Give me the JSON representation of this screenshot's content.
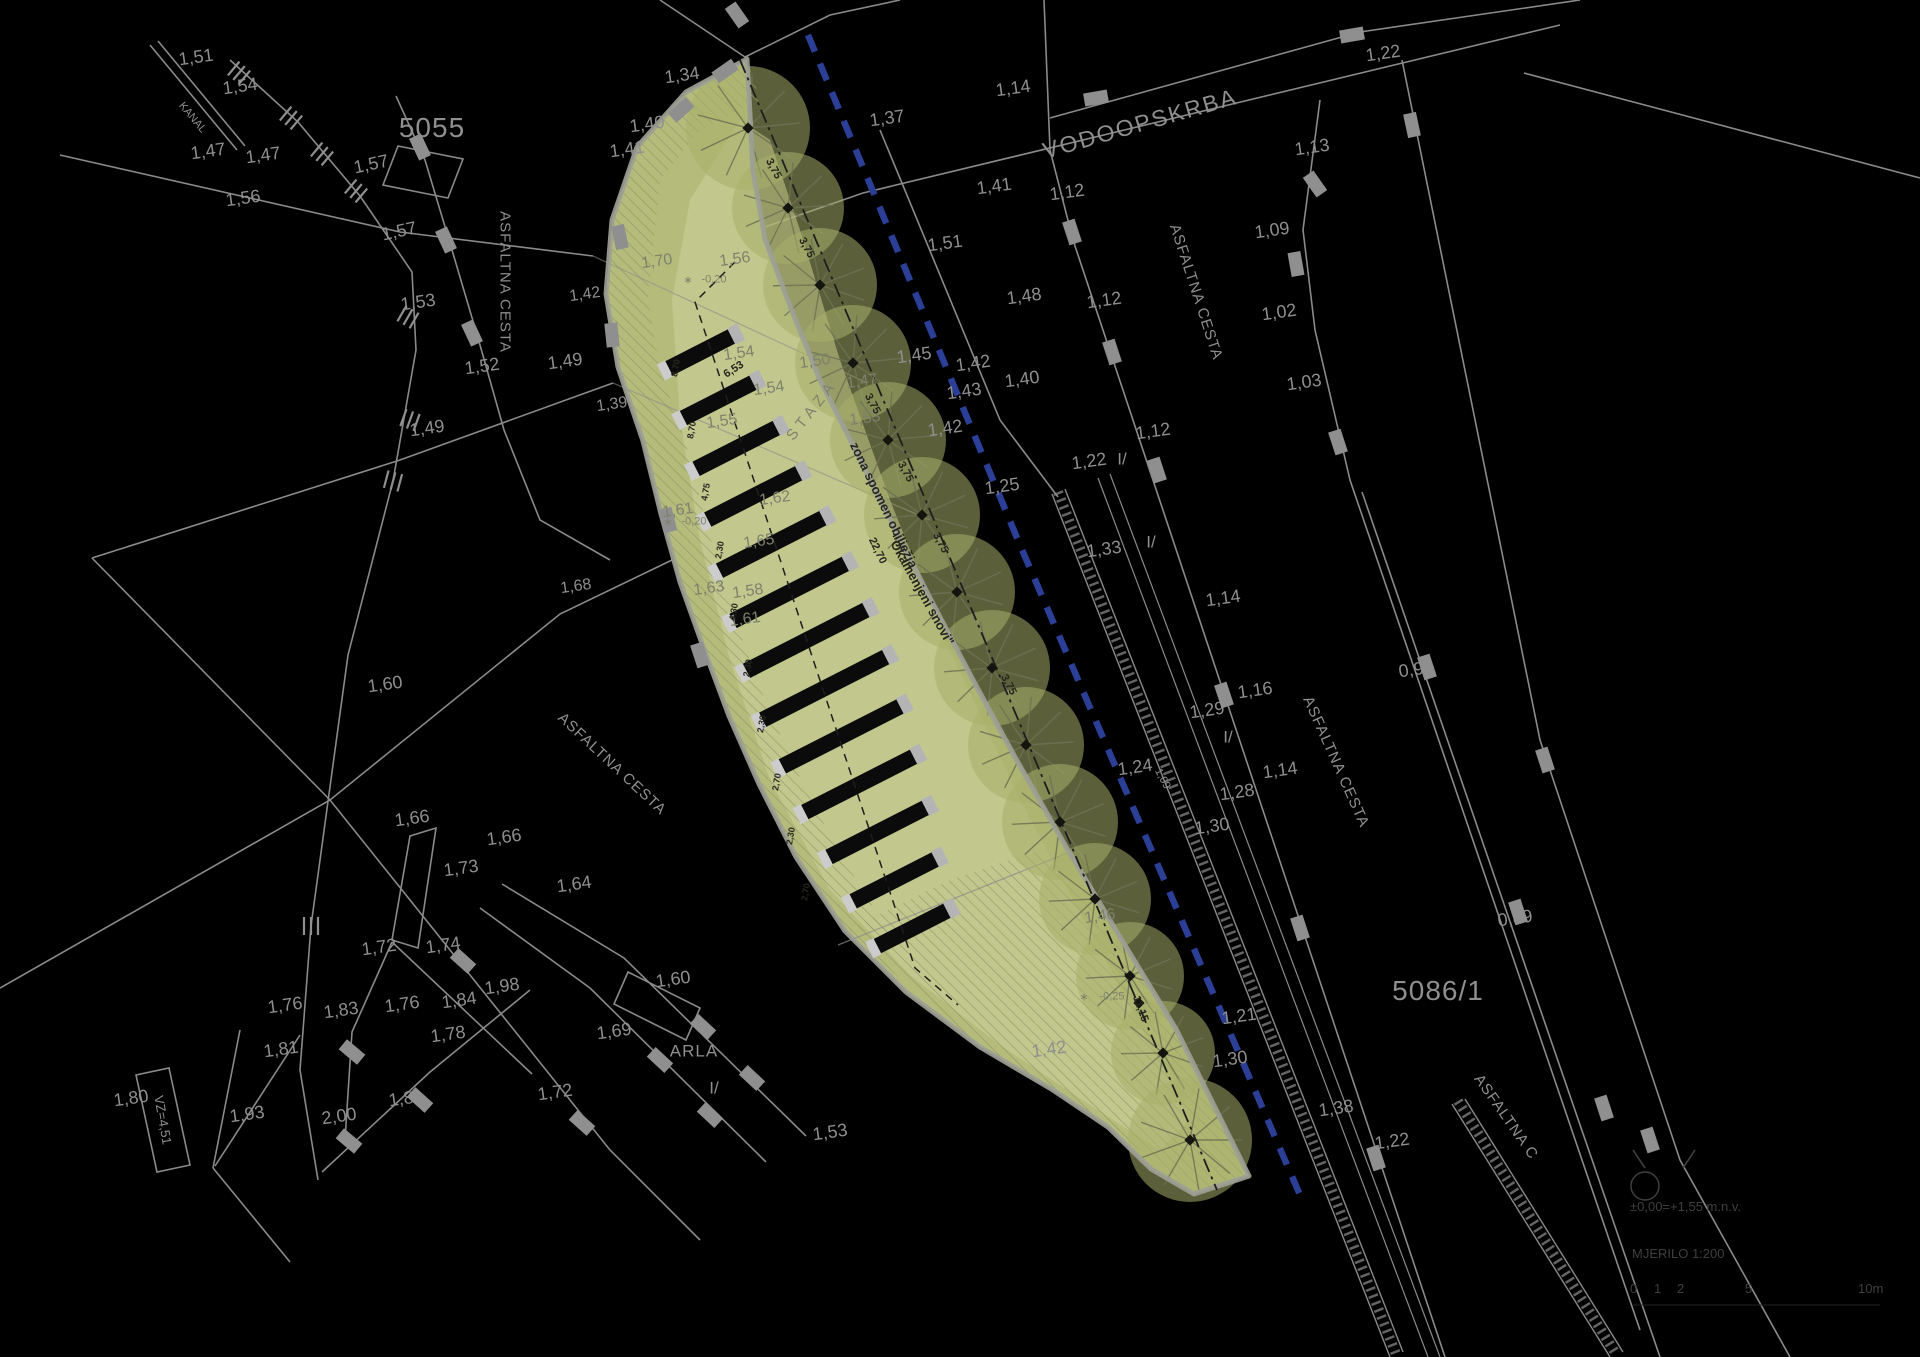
{
  "legend": {
    "datum_label": "±0,00=+1,55 m.n.v.",
    "scale_label": "MJERILO 1:200",
    "scalebar_ticks": [
      "0",
      "1",
      "2",
      "5",
      "10m"
    ]
  },
  "parcels": {
    "left": "5055",
    "right": "5086/1"
  },
  "zone_note": "zona spomen obilježja \"Okamenjeni snovi\"",
  "colors": {
    "background": "#000000",
    "line_gray": "#8a8a8a",
    "text_gray": "#8f8f8f",
    "green_base": "#b5bc7b",
    "green_light": "#c9ce97",
    "green_tree": "#a7ae6a",
    "border_gray": "#9da095",
    "blue_line": "#2b3f96",
    "legend_gray": "#3f3f3f"
  },
  "labels": [
    [
      "1,51",
      196,
      57,
      -8,
      18,
      "g"
    ],
    [
      "1,54",
      240,
      86,
      -8,
      18,
      "g"
    ],
    [
      "KANAL",
      192,
      118,
      50,
      11,
      "g"
    ],
    [
      "1,47",
      208,
      151,
      -8,
      18,
      "g"
    ],
    [
      "1,47",
      263,
      155,
      -8,
      18,
      "g"
    ],
    [
      "1,56",
      243,
      198,
      -8,
      18,
      "g"
    ],
    [
      "5055",
      432,
      128,
      0,
      28,
      "g",
      1
    ],
    [
      "1,57",
      371,
      164,
      -12,
      18,
      "g"
    ],
    [
      "1,57",
      399,
      231,
      -12,
      18,
      "g"
    ],
    [
      "1,53",
      418,
      302,
      -8,
      18,
      "g"
    ],
    [
      "ASFALTNA CESTA",
      505,
      282,
      90,
      15,
      "g",
      1
    ],
    [
      "1,52",
      482,
      366,
      -8,
      18,
      "g"
    ],
    [
      "1,49",
      565,
      361,
      -8,
      18,
      "g"
    ],
    [
      "1,49",
      427,
      428,
      -8,
      18,
      "g"
    ],
    [
      "1,60",
      385,
      684,
      -8,
      18,
      "g"
    ],
    [
      "ASFALTNA CESTA",
      612,
      764,
      43,
      15,
      "g",
      1
    ],
    [
      "1,66",
      412,
      818,
      -8,
      18,
      "g"
    ],
    [
      "1,66",
      504,
      837,
      -8,
      18,
      "g"
    ],
    [
      "1,73",
      461,
      868,
      -8,
      18,
      "g"
    ],
    [
      "1,64",
      574,
      884,
      -8,
      18,
      "g"
    ],
    [
      "1,72",
      379,
      947,
      -8,
      18,
      "g"
    ],
    [
      "1,74",
      443,
      945,
      -8,
      18,
      "g"
    ],
    [
      "1,98",
      502,
      986,
      -8,
      18,
      "g"
    ],
    [
      "1,84",
      459,
      1000,
      -8,
      18,
      "g"
    ],
    [
      "1,76",
      285,
      1005,
      -8,
      18,
      "g"
    ],
    [
      "1,76",
      402,
      1004,
      -8,
      18,
      "g"
    ],
    [
      "1,83",
      341,
      1010,
      -8,
      18,
      "g"
    ],
    [
      "1,78",
      448,
      1034,
      -8,
      18,
      "g"
    ],
    [
      "1,81",
      281,
      1049,
      -8,
      18,
      "g"
    ],
    [
      "1,80",
      131,
      1098,
      -8,
      18,
      "g"
    ],
    [
      "VZ=4,51",
      163,
      1120,
      80,
      13,
      "g"
    ],
    [
      "1,93",
      247,
      1114,
      -8,
      18,
      "g"
    ],
    [
      "2,00",
      339,
      1116,
      -8,
      18,
      "g"
    ],
    [
      "1,81",
      406,
      1098,
      -8,
      18,
      "g"
    ],
    [
      "1,69",
      614,
      1031,
      -8,
      18,
      "g"
    ],
    [
      "ARLA",
      694,
      1051,
      0,
      17,
      "g",
      1
    ],
    [
      "I/",
      714,
      1088,
      0,
      17,
      "g"
    ],
    [
      "1,72",
      555,
      1092,
      -8,
      18,
      "g"
    ],
    [
      "1,60",
      673,
      979,
      -8,
      18,
      "g"
    ],
    [
      "1,53",
      830,
      1132,
      -8,
      18,
      "g"
    ],
    [
      "1,34",
      682,
      75,
      -8,
      18,
      "g"
    ],
    [
      "1,40",
      647,
      124,
      -8,
      18,
      "g"
    ],
    [
      "1,41",
      627,
      149,
      -8,
      18,
      "g"
    ],
    [
      "1,37",
      887,
      118,
      -8,
      18,
      "g"
    ],
    [
      "1,14",
      1013,
      88,
      -8,
      18,
      "g"
    ],
    [
      "VODOOPSKRBA",
      1140,
      124,
      -16,
      23,
      "g",
      2
    ],
    [
      "1,41",
      994,
      186,
      -8,
      18,
      "g"
    ],
    [
      "1,12",
      1067,
      192,
      -8,
      18,
      "g"
    ],
    [
      "1,51",
      945,
      243,
      -8,
      18,
      "g"
    ],
    [
      "1,48",
      1024,
      296,
      -8,
      18,
      "g"
    ],
    [
      "1,12",
      1104,
      300,
      -8,
      18,
      "g"
    ],
    [
      "1,09",
      1272,
      230,
      -8,
      18,
      "g"
    ],
    [
      "1,02",
      1279,
      312,
      -8,
      18,
      "g"
    ],
    [
      "1,03",
      1304,
      382,
      -8,
      18,
      "g"
    ],
    [
      "1,13",
      1312,
      147,
      -8,
      18,
      "g"
    ],
    [
      "1,22",
      1383,
      53,
      -8,
      18,
      "g"
    ],
    [
      "ASFALTNA CESTA",
      1196,
      292,
      72,
      15,
      "g",
      1
    ],
    [
      "1,45",
      914,
      355,
      -8,
      18,
      "g"
    ],
    [
      "1,42",
      973,
      363,
      -8,
      18,
      "g"
    ],
    [
      "1,40",
      1022,
      379,
      -8,
      18,
      "g"
    ],
    [
      "1,43",
      964,
      391,
      -8,
      18,
      "g"
    ],
    [
      "1,42",
      945,
      428,
      -8,
      18,
      "g"
    ],
    [
      "1,12",
      1153,
      431,
      -8,
      18,
      "g"
    ],
    [
      "1,22",
      1089,
      461,
      -8,
      18,
      "g"
    ],
    [
      "I/",
      1122,
      459,
      0,
      17,
      "g"
    ],
    [
      "1,25",
      1002,
      486,
      -8,
      18,
      "g"
    ],
    [
      "1,33",
      1104,
      549,
      -8,
      18,
      "g"
    ],
    [
      "I/",
      1151,
      542,
      0,
      17,
      "g"
    ],
    [
      "1,14",
      1223,
      598,
      -8,
      18,
      "g"
    ],
    [
      "1,16",
      1255,
      690,
      -8,
      18,
      "g"
    ],
    [
      "1,29",
      1207,
      710,
      -8,
      18,
      "g"
    ],
    [
      "I/",
      1228,
      737,
      0,
      17,
      "g"
    ],
    [
      "1,14",
      1280,
      770,
      -8,
      18,
      "g"
    ],
    [
      "1,28",
      1237,
      792,
      -8,
      18,
      "g"
    ],
    [
      "1,24",
      1135,
      767,
      -8,
      18,
      "g"
    ],
    [
      "1,09",
      1162,
      779,
      62,
      11,
      "g"
    ],
    [
      "1,30",
      1212,
      826,
      -8,
      18,
      "g"
    ],
    [
      "0,99",
      1416,
      669,
      -8,
      18,
      "g"
    ],
    [
      "ASFALTNA CESTA",
      1336,
      762,
      66,
      15,
      "g",
      1
    ],
    [
      "0,89",
      1515,
      918,
      -8,
      18,
      "g"
    ],
    [
      "5086/1",
      1438,
      991,
      0,
      28,
      "g",
      1
    ],
    [
      "1,21",
      1239,
      1016,
      -8,
      18,
      "g"
    ],
    [
      "1,30",
      1230,
      1059,
      -8,
      18,
      "g"
    ],
    [
      "1,38",
      1336,
      1108,
      -8,
      18,
      "g"
    ],
    [
      "1,22",
      1392,
      1141,
      -8,
      18,
      "g"
    ],
    [
      "ASFALTNA C",
      1506,
      1117,
      55,
      15,
      "g",
      1
    ],
    [
      "1,42",
      1049,
      1049,
      -8,
      18,
      "g"
    ],
    [
      "1,56",
      735,
      260,
      -8,
      16,
      "d"
    ],
    [
      "1,70",
      657,
      262,
      -8,
      16,
      "d"
    ],
    [
      "∗",
      688,
      281,
      0,
      11,
      "d"
    ],
    [
      "-0,20",
      714,
      280,
      0,
      11,
      "d"
    ],
    [
      "1,54",
      739,
      354,
      -8,
      16,
      "d"
    ],
    [
      "1,54",
      769,
      389,
      -8,
      16,
      "d"
    ],
    [
      "1,55",
      722,
      422,
      -8,
      16,
      "d"
    ],
    [
      "1,62",
      775,
      499,
      -8,
      16,
      "d"
    ],
    [
      "1,65",
      759,
      542,
      -8,
      16,
      "d"
    ],
    [
      "1,63",
      709,
      589,
      -8,
      16,
      "d"
    ],
    [
      "1,58",
      748,
      592,
      -8,
      16,
      "d"
    ],
    [
      "1,61",
      678,
      511,
      -8,
      16,
      "d"
    ],
    [
      "∗",
      668,
      523,
      0,
      11,
      "d"
    ],
    [
      "-0,20",
      694,
      522,
      0,
      11,
      "d"
    ],
    [
      "1,61",
      745,
      620,
      -8,
      16,
      "d"
    ],
    [
      "1,50",
      815,
      362,
      -8,
      16,
      "d"
    ],
    [
      "1,47",
      862,
      382,
      -8,
      16,
      "d"
    ],
    [
      "1,53",
      865,
      419,
      -8,
      16,
      "d"
    ],
    [
      "6,53",
      734,
      370,
      -33,
      11,
      "k"
    ],
    [
      "STAZA",
      812,
      410,
      -52,
      15,
      "d",
      5
    ],
    [
      "1,68",
      576,
      587,
      -8,
      16,
      "g"
    ],
    [
      "1,39",
      612,
      405,
      -8,
      16,
      "g"
    ],
    [
      "1,42",
      585,
      295,
      -8,
      16,
      "g"
    ],
    [
      "1,46",
      1100,
      917,
      -8,
      16,
      "d"
    ],
    [
      "zona spomen obilježja",
      884,
      505,
      64,
      13,
      "k"
    ],
    [
      "\"Okamenjeni snovi\"",
      921,
      590,
      61,
      13,
      "k"
    ],
    [
      "22,70",
      877,
      551,
      64,
      11,
      "k"
    ],
    [
      "11,15",
      1140,
      1009,
      70,
      11,
      "k"
    ],
    [
      "3,75",
      773,
      169,
      62,
      11,
      "k"
    ],
    [
      "3,75",
      806,
      248,
      62,
      11,
      "k"
    ],
    [
      "3,75",
      872,
      404,
      62,
      11,
      "k"
    ],
    [
      "3,75",
      905,
      472,
      62,
      11,
      "k"
    ],
    [
      "3,75",
      940,
      543,
      62,
      11,
      "k"
    ],
    [
      "3,75",
      1008,
      685,
      62,
      11,
      "k"
    ],
    [
      "∗",
      1084,
      998,
      0,
      11,
      "d"
    ],
    [
      "-0,25",
      1112,
      997,
      0,
      11,
      "d"
    ],
    [
      "8,70",
      676,
      368,
      -80,
      9,
      "k"
    ],
    [
      "8,70",
      692,
      430,
      -80,
      9,
      "k"
    ],
    [
      "4,75",
      706,
      492,
      -80,
      9,
      "k"
    ],
    [
      "2,30",
      720,
      550,
      -80,
      9,
      "k"
    ],
    [
      "4,30",
      734,
      612,
      -80,
      9,
      "k"
    ],
    [
      "2,30",
      748,
      668,
      -80,
      9,
      "k"
    ],
    [
      "2,30",
      762,
      724,
      -80,
      9,
      "k"
    ],
    [
      "2,70",
      777,
      782,
      -80,
      9,
      "k"
    ],
    [
      "2,30",
      791,
      836,
      -80,
      9,
      "k"
    ],
    [
      "2,70",
      806,
      892,
      -80,
      9,
      "k"
    ]
  ],
  "trees": [
    [
      748,
      128,
      52
    ],
    [
      788,
      208,
      46
    ],
    [
      820,
      285,
      47
    ],
    [
      853,
      363,
      48
    ],
    [
      888,
      440,
      48
    ],
    [
      922,
      515,
      48
    ],
    [
      957,
      592,
      48
    ],
    [
      992,
      668,
      48
    ],
    [
      1026,
      745,
      48
    ],
    [
      1060,
      822,
      48
    ],
    [
      1095,
      899,
      46
    ],
    [
      1130,
      976,
      44
    ],
    [
      1163,
      1053,
      42
    ],
    [
      1190,
      1140,
      52
    ]
  ],
  "extra_nodes": [
    [
      1139,
      1003
    ]
  ],
  "bars": [
    [
      701,
      352,
      72
    ],
    [
      719,
      400,
      80
    ],
    [
      737,
      448,
      92
    ],
    [
      754,
      496,
      104
    ],
    [
      772,
      544,
      118
    ],
    [
      790,
      592,
      128
    ],
    [
      807,
      640,
      136
    ],
    [
      825,
      688,
      140
    ],
    [
      842,
      736,
      134
    ],
    [
      860,
      784,
      124
    ],
    [
      878,
      832,
      110
    ],
    [
      895,
      880,
      94
    ],
    [
      913,
      928,
      80
    ]
  ],
  "road_markers": [
    [
      737,
      15,
      55
    ],
    [
      1096,
      98,
      -10
    ],
    [
      1352,
      35,
      -10
    ],
    [
      1072,
      232,
      72
    ],
    [
      1112,
      352,
      72
    ],
    [
      1157,
      470,
      72
    ],
    [
      1224,
      695,
      72
    ],
    [
      1300,
      928,
      72
    ],
    [
      1376,
      1158,
      72
    ],
    [
      1315,
      184,
      55
    ],
    [
      1296,
      264,
      80
    ],
    [
      1338,
      442,
      72
    ],
    [
      1427,
      667,
      72
    ],
    [
      1518,
      912,
      72
    ],
    [
      1604,
      1108,
      72
    ],
    [
      1412,
      125,
      78
    ],
    [
      1545,
      760,
      72
    ],
    [
      1650,
      1140,
      72
    ],
    [
      420,
      147,
      65
    ],
    [
      446,
      240,
      65
    ],
    [
      472,
      333,
      65
    ],
    [
      725,
      71,
      -35
    ],
    [
      681,
      110,
      -42
    ],
    [
      620,
      237,
      78
    ],
    [
      612,
      335,
      84
    ],
    [
      668,
      520,
      76
    ],
    [
      700,
      655,
      72
    ],
    [
      463,
      961,
      42
    ],
    [
      582,
      1123,
      42
    ],
    [
      703,
      1027,
      43
    ],
    [
      660,
      1060,
      43
    ],
    [
      752,
      1078,
      43
    ],
    [
      710,
      1115,
      43
    ],
    [
      420,
      1100,
      42
    ],
    [
      352,
      1052,
      40
    ],
    [
      349,
      1141,
      40
    ]
  ],
  "slope_ticks": [
    [
      291,
      118,
      40
    ],
    [
      322,
      154,
      40
    ],
    [
      356,
      191,
      40
    ],
    [
      408,
      317,
      30
    ],
    [
      393,
      481,
      15
    ],
    [
      311,
      926,
      0
    ],
    [
      239,
      73,
      40
    ],
    [
      410,
      420,
      20
    ]
  ]
}
